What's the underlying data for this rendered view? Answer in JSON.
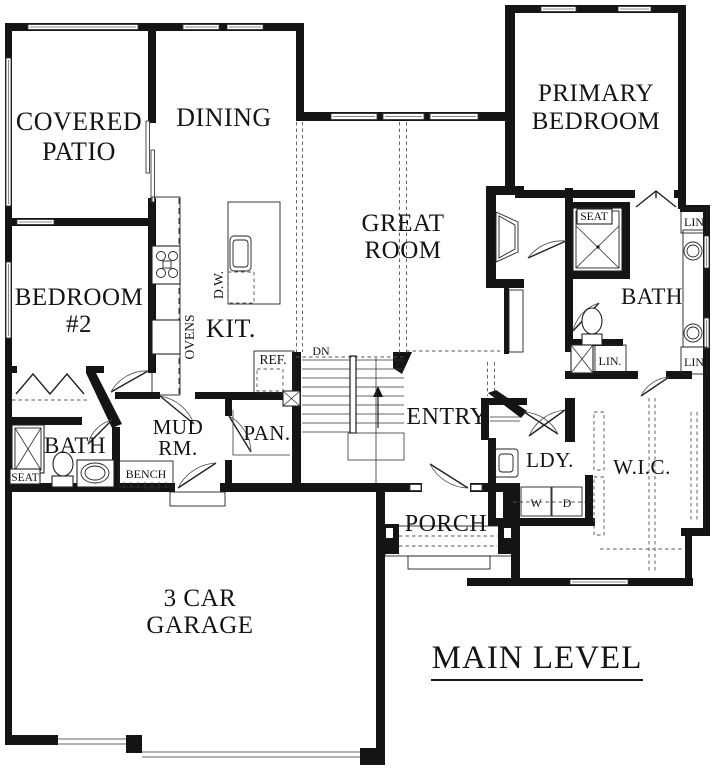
{
  "plan": {
    "title": "MAIN LEVEL",
    "rooms": {
      "covered_patio_1": "COVERED",
      "covered_patio_2": "PATIO",
      "dining": "DINING",
      "primary_bedroom_1": "PRIMARY",
      "primary_bedroom_2": "BEDROOM",
      "great_room_1": "GREAT",
      "great_room_2": "ROOM",
      "bedroom2_1": "BEDROOM",
      "bedroom2_2": "#2",
      "kitchen": "KIT.",
      "mud_room_1": "MUD",
      "mud_room_2": "RM.",
      "pantry": "PAN.",
      "entry": "ENTRY",
      "bath_left": "BATH",
      "porch": "PORCH",
      "garage_1": "3 CAR",
      "garage_2": "GARAGE",
      "laundry": "LDY.",
      "walk_in_closet": "W.I.C.",
      "bath_right": "BATH"
    },
    "fixtures": {
      "ovens": "OVENS",
      "dishwasher": "D.W.",
      "refrigerator": "REF.",
      "stairs_down": "DN",
      "bench": "BENCH",
      "seat_left": "SEAT",
      "seat_right": "SEAT",
      "washer": "W",
      "dryer": "D",
      "linen_top_right": "LIN",
      "linen_bottom_right": "LIN",
      "linen_bath": "LIN."
    },
    "colors": {
      "wall": "#141414",
      "background": "#ffffff",
      "window": "#8a8a8a"
    }
  }
}
